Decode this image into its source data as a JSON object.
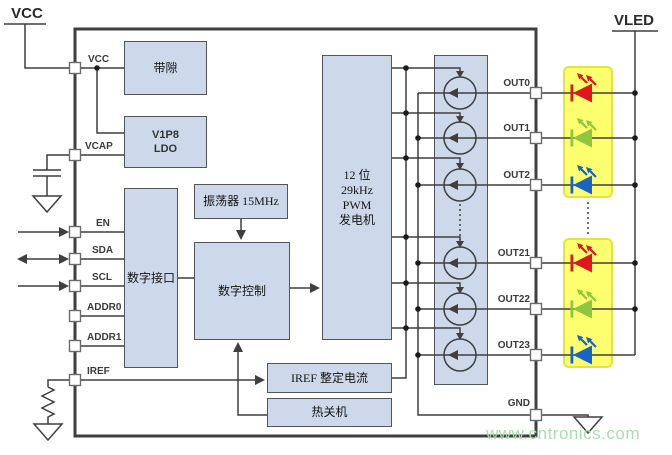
{
  "diagram": {
    "supply_left": "VCC",
    "supply_right": "VLED",
    "watermark": "www.cntronics.com"
  },
  "blocks": {
    "bandgap": "带隙",
    "ldo_lines": [
      "V1P8",
      "LDO"
    ],
    "digital_interface": "数字接口",
    "oscillator": "振荡器 15MHz",
    "digital_control": "数字控制",
    "pwm_lines": [
      "12 位",
      "29kHz",
      "PWM",
      "发电机"
    ],
    "iref_trim": "IREF 整定电流",
    "thermal_shutdown": "热关机"
  },
  "pins": {
    "left": [
      "VCC",
      "VCAP",
      "EN",
      "SDA",
      "SCL",
      "ADDR0",
      "ADDR1",
      "IREF"
    ],
    "right": [
      "OUT0",
      "OUT1",
      "OUT2",
      "OUT21",
      "OUT22",
      "OUT23",
      "GND"
    ]
  },
  "icons": {
    "current_source": "current-source-circle",
    "led": "led-symbol",
    "ground": "ground-symbol",
    "resistor": "resistor-symbol",
    "capacitor": "capacitor-symbol"
  },
  "colors": {
    "block_fill": "#cdd9ea",
    "block_border": "#50565c",
    "wire": "#3f3f3f",
    "led_red": "#e0161f",
    "led_green": "#8dc63f",
    "led_blue": "#1763c6",
    "led_panel_fill": "#fdff6e",
    "led_panel_border": "#e4e43c",
    "watermark_green": "#aadfaa"
  }
}
